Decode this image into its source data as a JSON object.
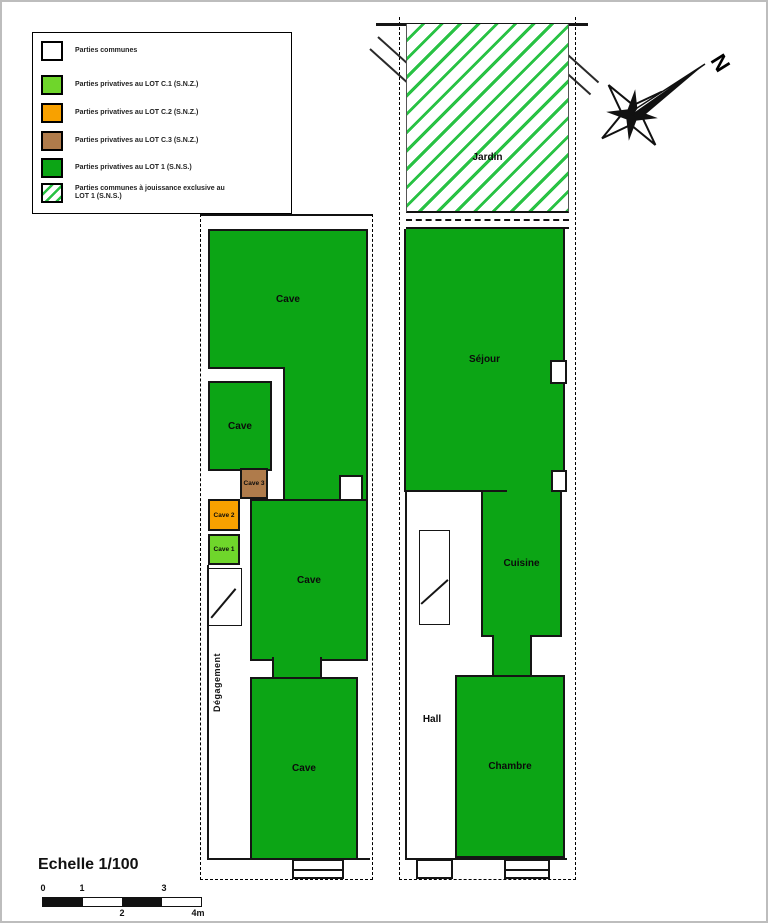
{
  "colors": {
    "common": "#FFFFFF",
    "lot_c1": "#6FD62B",
    "lot_c2": "#F8A100",
    "lot_c3": "#AF7B4B",
    "lot_1": "#0CA515",
    "hatch_line": "#29C244"
  },
  "legend": {
    "items": [
      {
        "label": "Parties communes",
        "color": "#FFFFFF"
      },
      {
        "label": "Parties privatives au LOT C.1 (S.N.Z.)",
        "color": "#6FD62B"
      },
      {
        "label": "Parties privatives au LOT C.2 (S.N.Z.)",
        "color": "#F8A100"
      },
      {
        "label": "Parties privatives au LOT C.3 (S.N.Z.)",
        "color": "#AF7B4B"
      },
      {
        "label": "Parties privatives au LOT 1 (S.N.S.)",
        "color": "#0CA515"
      },
      {
        "label": "Parties communes à jouissance exclusive au LOT 1 (S.N.S.)"
      }
    ]
  },
  "compass": {
    "north": "N"
  },
  "plans": {
    "basement": {
      "rooms": {
        "top_cave": "Cave",
        "small_cave": "Cave",
        "cave3": "Cave 3",
        "cave2": "Cave 2",
        "cave1": "Cave 1",
        "middle_cave": "Cave",
        "bottom_cave": "Cave",
        "corridor": "Dégagement"
      }
    },
    "ground": {
      "rooms": {
        "jardin": "Jardin",
        "sejour": "Séjour",
        "cuisine": "Cuisine",
        "hall": "Hall",
        "chambre": "Chambre"
      }
    }
  },
  "scale": {
    "title": "Echelle 1/100",
    "ticks_top": [
      "0",
      "1",
      "3"
    ],
    "ticks_bottom": [
      "2",
      "4m"
    ]
  }
}
